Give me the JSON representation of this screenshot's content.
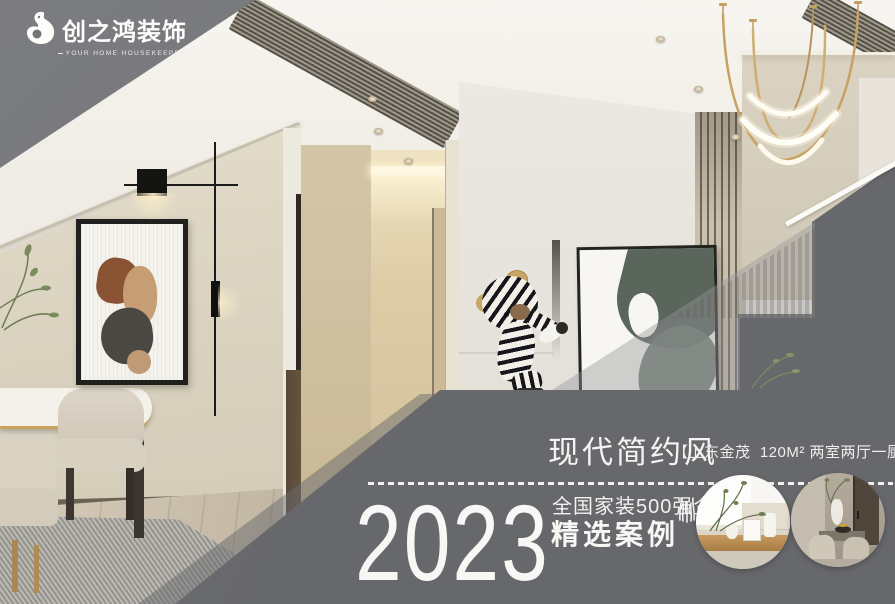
{
  "brand": {
    "name": "创之鸿装饰",
    "tagline": "YOUR HOME HOUSEKEEPER"
  },
  "overlay": {
    "style_title": "现代简约风",
    "project_info": "【上东金茂  120M² 两室两厅一厨两卫】",
    "year": "2023",
    "award_line1": "全国家装500强企业",
    "award_line2": "精选案例"
  },
  "icons": {
    "logo": "swan-bird",
    "decoration": "laurel-sprig"
  },
  "colors": {
    "overlay_gray": "#6b6c6f",
    "triangle_gray": "#77787b",
    "text_white": "#f5f5f4",
    "gold": "#c8a262"
  },
  "thumbnails": [
    {
      "name": "tea-table-scene"
    },
    {
      "name": "dining-room-scene"
    }
  ]
}
